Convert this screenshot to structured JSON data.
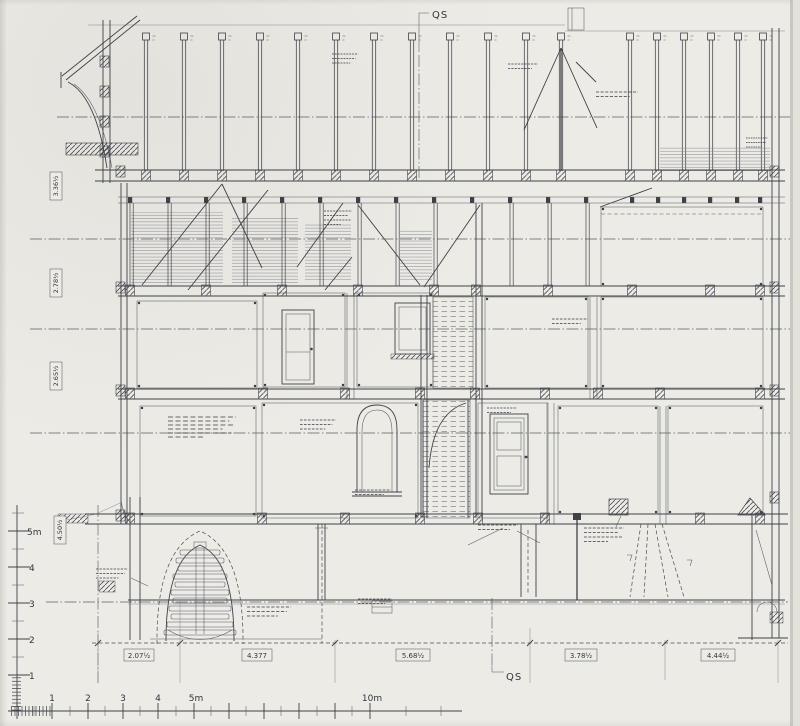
{
  "drawing": {
    "section_marker_top": "QS",
    "section_marker_bottom": "QS"
  },
  "scale_bar": {
    "horizontal_labels": [
      "1",
      "2",
      "3",
      "4",
      "5m",
      "10m"
    ],
    "vertical_labels": [
      "5m",
      "4",
      "3",
      "2",
      "1"
    ]
  },
  "dimensions_bottom": [
    "2.07½",
    "4.377",
    "5.68½",
    "3.78½",
    "4.44½"
  ],
  "storey_heights": [
    "3.36½",
    "2.78½",
    "2.65½",
    "4.50½"
  ],
  "colors": {
    "paper": "#edebe5",
    "ink": "#3f4146"
  }
}
